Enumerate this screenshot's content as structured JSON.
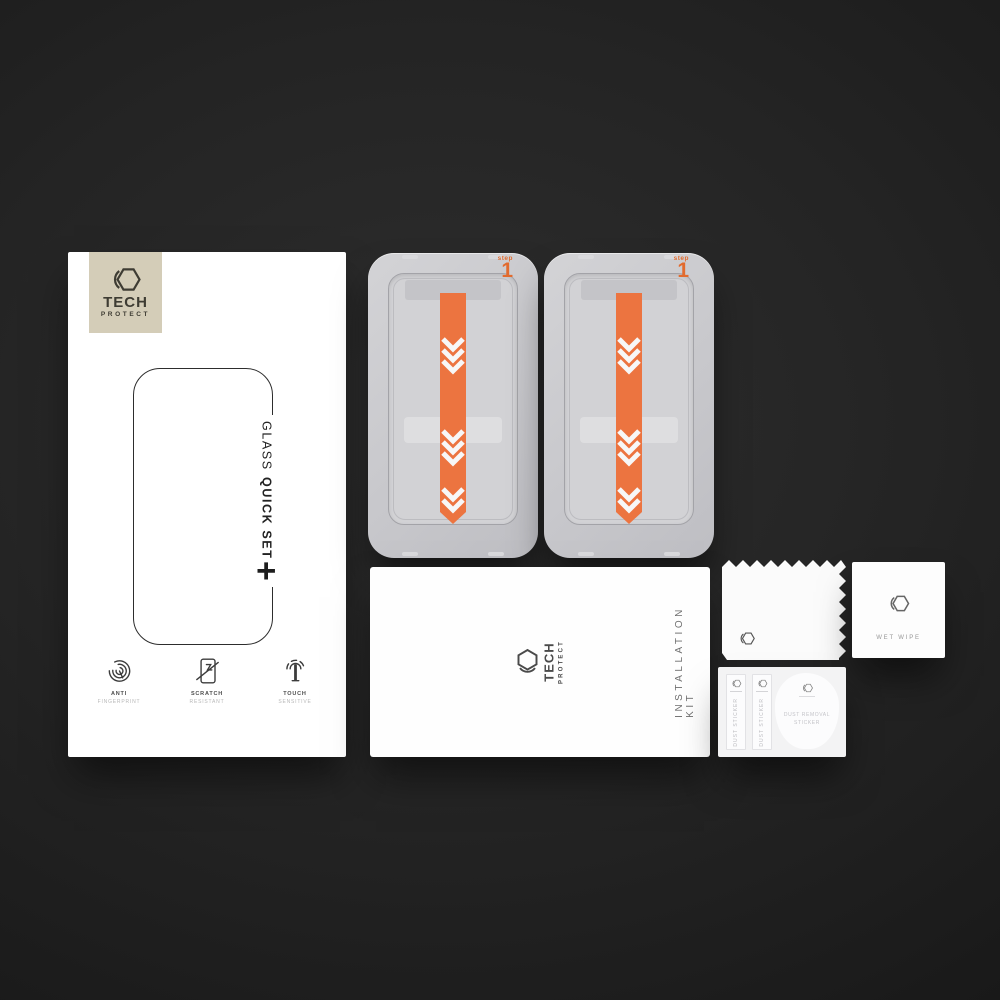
{
  "colors": {
    "accent_orange": "#ec7440",
    "badge_beige": "#d4cdb8",
    "background": "#232323"
  },
  "retail_box": {
    "logo": {
      "brand": "TECH",
      "sub_brand": "PROTECT",
      "icon": "hexagon-logo"
    },
    "product_name_thin": "GLASS",
    "product_name_bold": "QUICK SET",
    "plus_mark": "+",
    "features": [
      {
        "icon": "fingerprint-icon",
        "title": "ANTI",
        "subtitle": "FINGERPRINT"
      },
      {
        "icon": "scratch-icon",
        "title": "SCRATCH",
        "subtitle": "RESISTANT"
      },
      {
        "icon": "touch-icon",
        "title": "TOUCH",
        "subtitle": "SENSITIVE"
      }
    ]
  },
  "applicator_trays": [
    {
      "step_word": "step",
      "step_number": "1"
    },
    {
      "step_word": "step",
      "step_number": "1"
    }
  ],
  "installation_kit_envelope": {
    "brand": "TECH",
    "sub_brand": "PROTECT",
    "side_label": "INSTALLATION KIT"
  },
  "wet_wipe_sachet": {
    "label": "WET WIPE"
  },
  "sticker_sheet": {
    "strips": [
      {
        "label": "DUST STICKER"
      },
      {
        "label": "DUST STICKER"
      }
    ],
    "removal_pad": {
      "line1": "DUST REMOVAL",
      "line2": "STICKER"
    }
  }
}
